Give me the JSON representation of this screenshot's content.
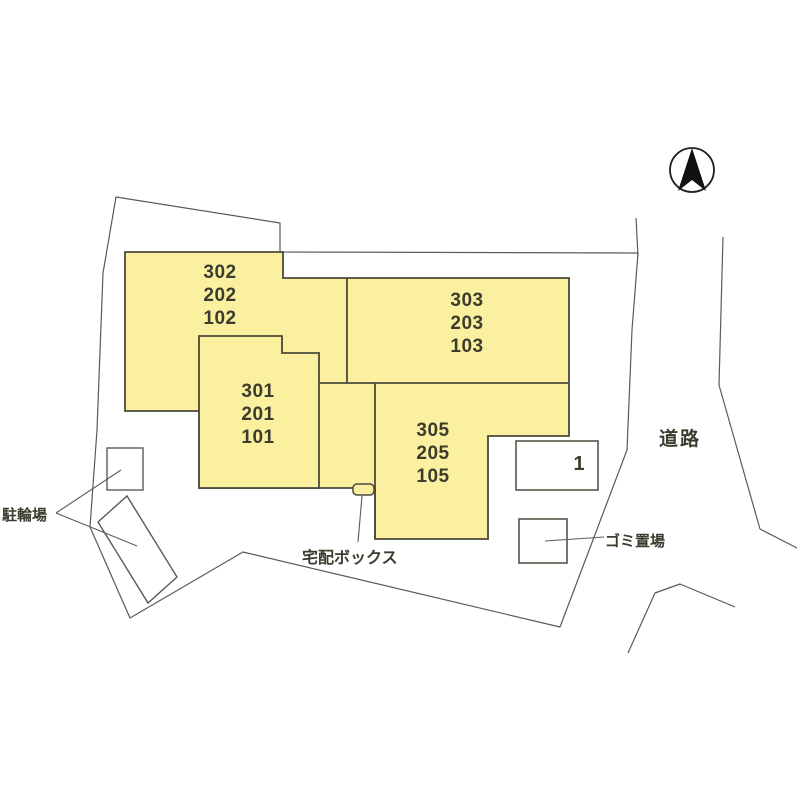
{
  "plan": {
    "title_hint": "site-plan",
    "buildings": [
      {
        "id": "west-stack",
        "units": [
          "302",
          "202",
          "102"
        ]
      },
      {
        "id": "north-stack",
        "units": [
          "303",
          "203",
          "103"
        ]
      },
      {
        "id": "mid-stack",
        "units": [
          "301",
          "201",
          "101"
        ]
      },
      {
        "id": "south-stack",
        "units": [
          "305",
          "205",
          "105"
        ]
      }
    ],
    "parking": {
      "space": "1"
    },
    "labels": {
      "bicycle_parking": "駐輪場",
      "delivery_box": "宅配ボックス",
      "garbage_area": "ゴミ置場",
      "road": "道路"
    },
    "icons": {
      "north": "north-compass-icon"
    },
    "colors": {
      "building_fill": "#FAF0A0",
      "building_outline": "#4a4a3a",
      "boundary_line": "#5a5a5a",
      "needle": "#111111"
    }
  }
}
